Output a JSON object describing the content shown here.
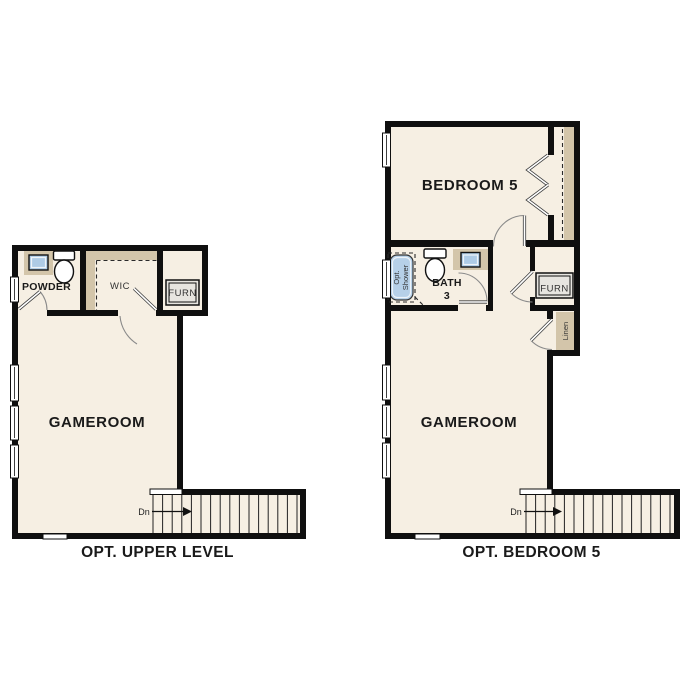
{
  "colors": {
    "background": "#ffffff",
    "floor": "#f6efe3",
    "wall": "#0f0f0f",
    "counter_tan": "#d3c5aa",
    "fixture_blue": "#aecbe6",
    "furnace_gray": "#e7e5e0"
  },
  "plans": [
    {
      "id": "opt-upper-level",
      "caption": "OPT. UPPER LEVEL",
      "labels": {
        "gameroom": "GAMEROOM",
        "powder": "POWDER",
        "wic": "WIC",
        "furnace": "FURN",
        "stairs_dir": "Dn"
      }
    },
    {
      "id": "opt-bedroom-5",
      "caption": "OPT. BEDROOM 5",
      "labels": {
        "bedroom": "BEDROOM 5",
        "gameroom": "GAMEROOM",
        "bath_line1": "BATH",
        "bath_line2": "3",
        "furnace": "FURN",
        "linen": "Linen",
        "shower_line1": "Opt.",
        "shower_line2": "Shower",
        "stairs_dir": "Dn"
      }
    }
  ]
}
